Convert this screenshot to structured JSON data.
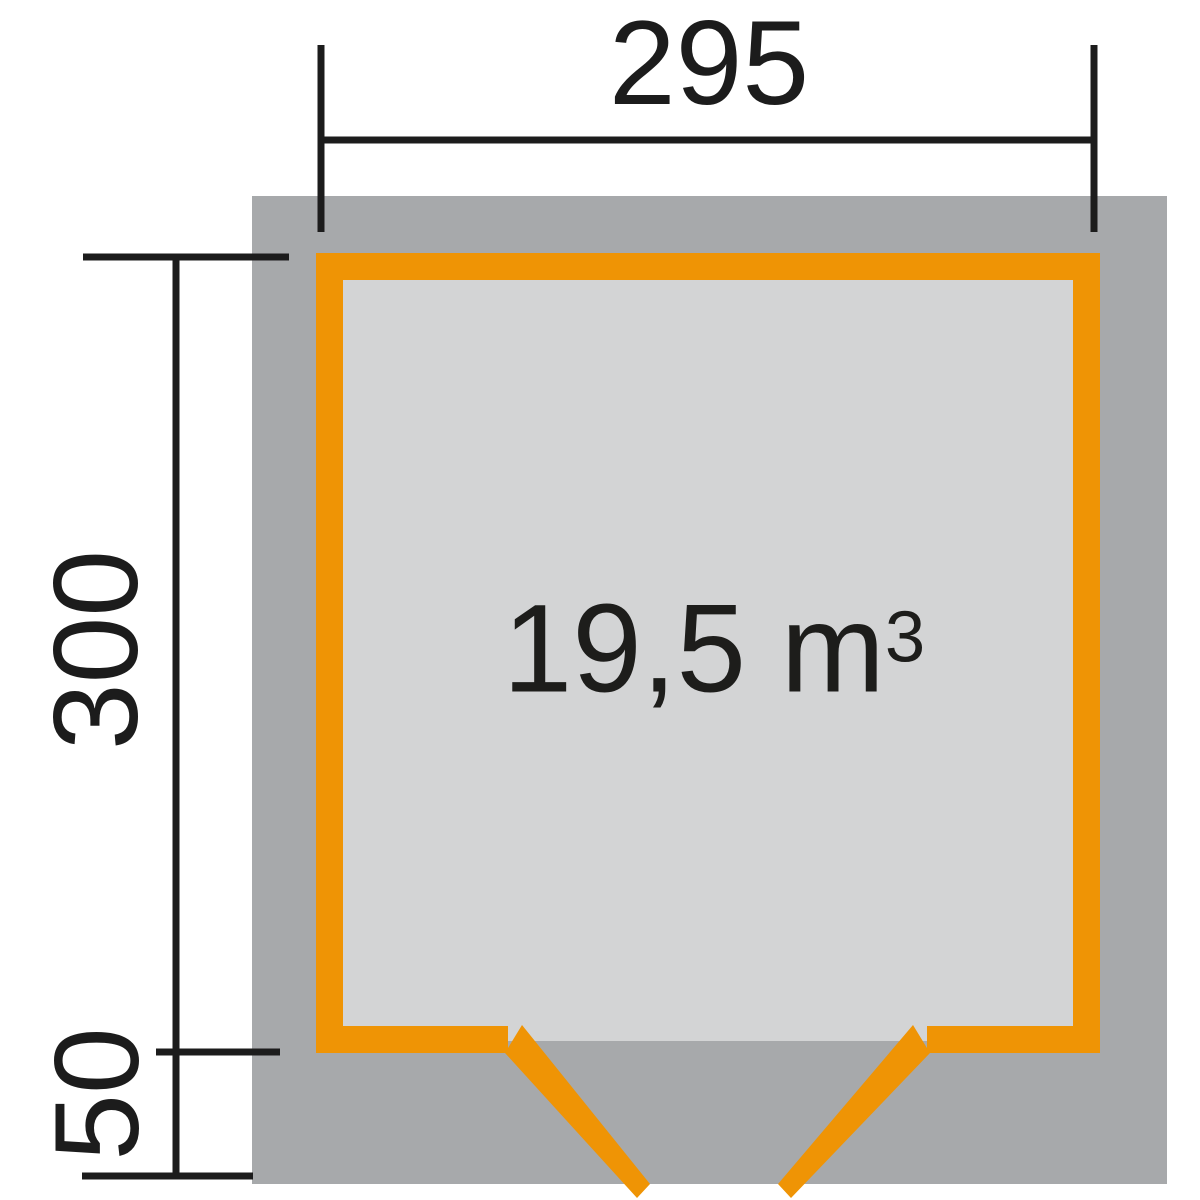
{
  "plan": {
    "title": "garden-house floor plan with outer roof footprint, orange wall frame and double door opening",
    "dimensions": {
      "width_label": "295",
      "height_label": "300",
      "front_overhang_label": "50"
    },
    "volume": {
      "value": "19,5 m",
      "sup": "3"
    },
    "colors": {
      "wall_orange": "#ef9405",
      "roof_footprint_gray": "#a7a9ab",
      "interior_gray": "#d3d4d5",
      "dimension_line_black": "#1c1c1c",
      "background": "#ffffff"
    }
  }
}
